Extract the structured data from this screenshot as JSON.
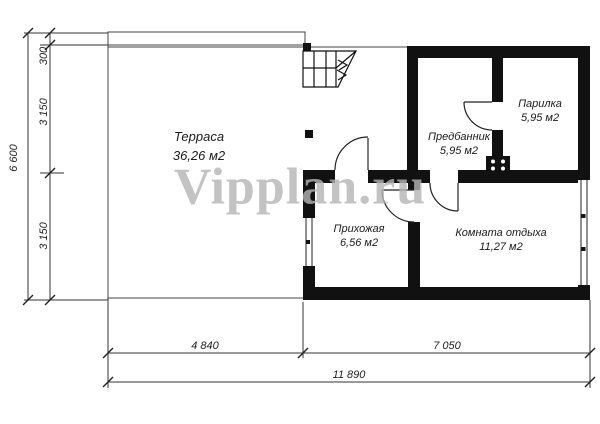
{
  "watermark": "Vipplan.ru",
  "rooms": {
    "terrace": {
      "name": "Терраса",
      "area": "36,26 м2"
    },
    "parilka": {
      "name": "Парилка",
      "area": "5,95 м2"
    },
    "predbannik": {
      "name": "Предбанник",
      "area": "5,95 м2"
    },
    "hallway": {
      "name": "Прихожая",
      "area": "6,56 м2"
    },
    "lounge": {
      "name": "Комната отдыха",
      "area": "11,27 м2"
    }
  },
  "dimensions": {
    "left_total": "6 600",
    "left_seg_300": "300",
    "left_seg_3150a": "3 150",
    "left_seg_3150b": "3 150",
    "bottom_seg_4840": "4 840",
    "bottom_seg_7050": "7 050",
    "bottom_total": "11 890"
  },
  "colors": {
    "wall": "#111111",
    "line": "#333333",
    "watermark": "#b5b5b5",
    "background": "#ffffff"
  }
}
